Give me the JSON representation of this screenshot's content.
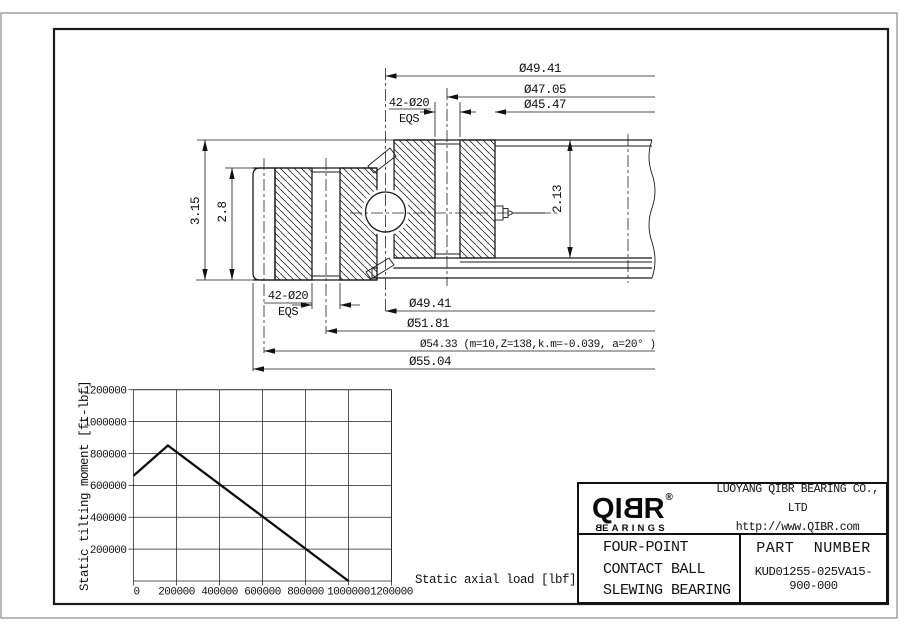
{
  "drawing": {
    "dims": {
      "top_1": "Ø49.41",
      "top_2": "Ø47.05",
      "top_3": "Ø45.47",
      "bolt_top_qty": "42-Ø20",
      "bolt_top_note": "EQS",
      "left_outer": "3.15",
      "left_inner": "2.8",
      "right": "2.13",
      "bolt_bottom_qty": "42-Ø20",
      "bolt_bottom_note": "EQS",
      "bottom_1": "Ø49.41",
      "bottom_2": "Ø51.81",
      "bottom_3": "Ø54.33 (m=10,Z=138,k.m=-0.039, a=20° )",
      "bottom_4": "Ø55.04"
    }
  },
  "chart_data": {
    "type": "line",
    "title": "",
    "xlabel": "Static axial load [lbf]",
    "ylabel": "Static tilting moment [ft-lbf]",
    "xlim": [
      0,
      1200000
    ],
    "ylim": [
      0,
      1200000
    ],
    "xticks": [
      0,
      200000,
      400000,
      600000,
      800000,
      1000000,
      1200000
    ],
    "yticks": [
      200000,
      400000,
      600000,
      800000,
      1000000,
      1200000
    ],
    "grid": true,
    "legend": false,
    "series": [
      {
        "name": "static-capacity-curve",
        "points": [
          [
            0,
            660000
          ],
          [
            160000,
            850000
          ],
          [
            1000000,
            0
          ]
        ]
      }
    ]
  },
  "title_block": {
    "logo": {
      "q": "Q",
      "i": "I",
      "b": "B",
      "r": "R",
      "reg": "®",
      "sub_first": "B",
      "sub_rest": "EARINGS"
    },
    "company": "LUOYANG QIBR BEARING CO., LTD",
    "website": "http://www.QIBR.com",
    "product_lines": [
      "FOUR-POINT",
      "CONTACT BALL",
      "SLEWING BEARING"
    ],
    "part_number_label": "PART NUMBER",
    "part_number": "KUD01255-025VA15-900-000"
  }
}
